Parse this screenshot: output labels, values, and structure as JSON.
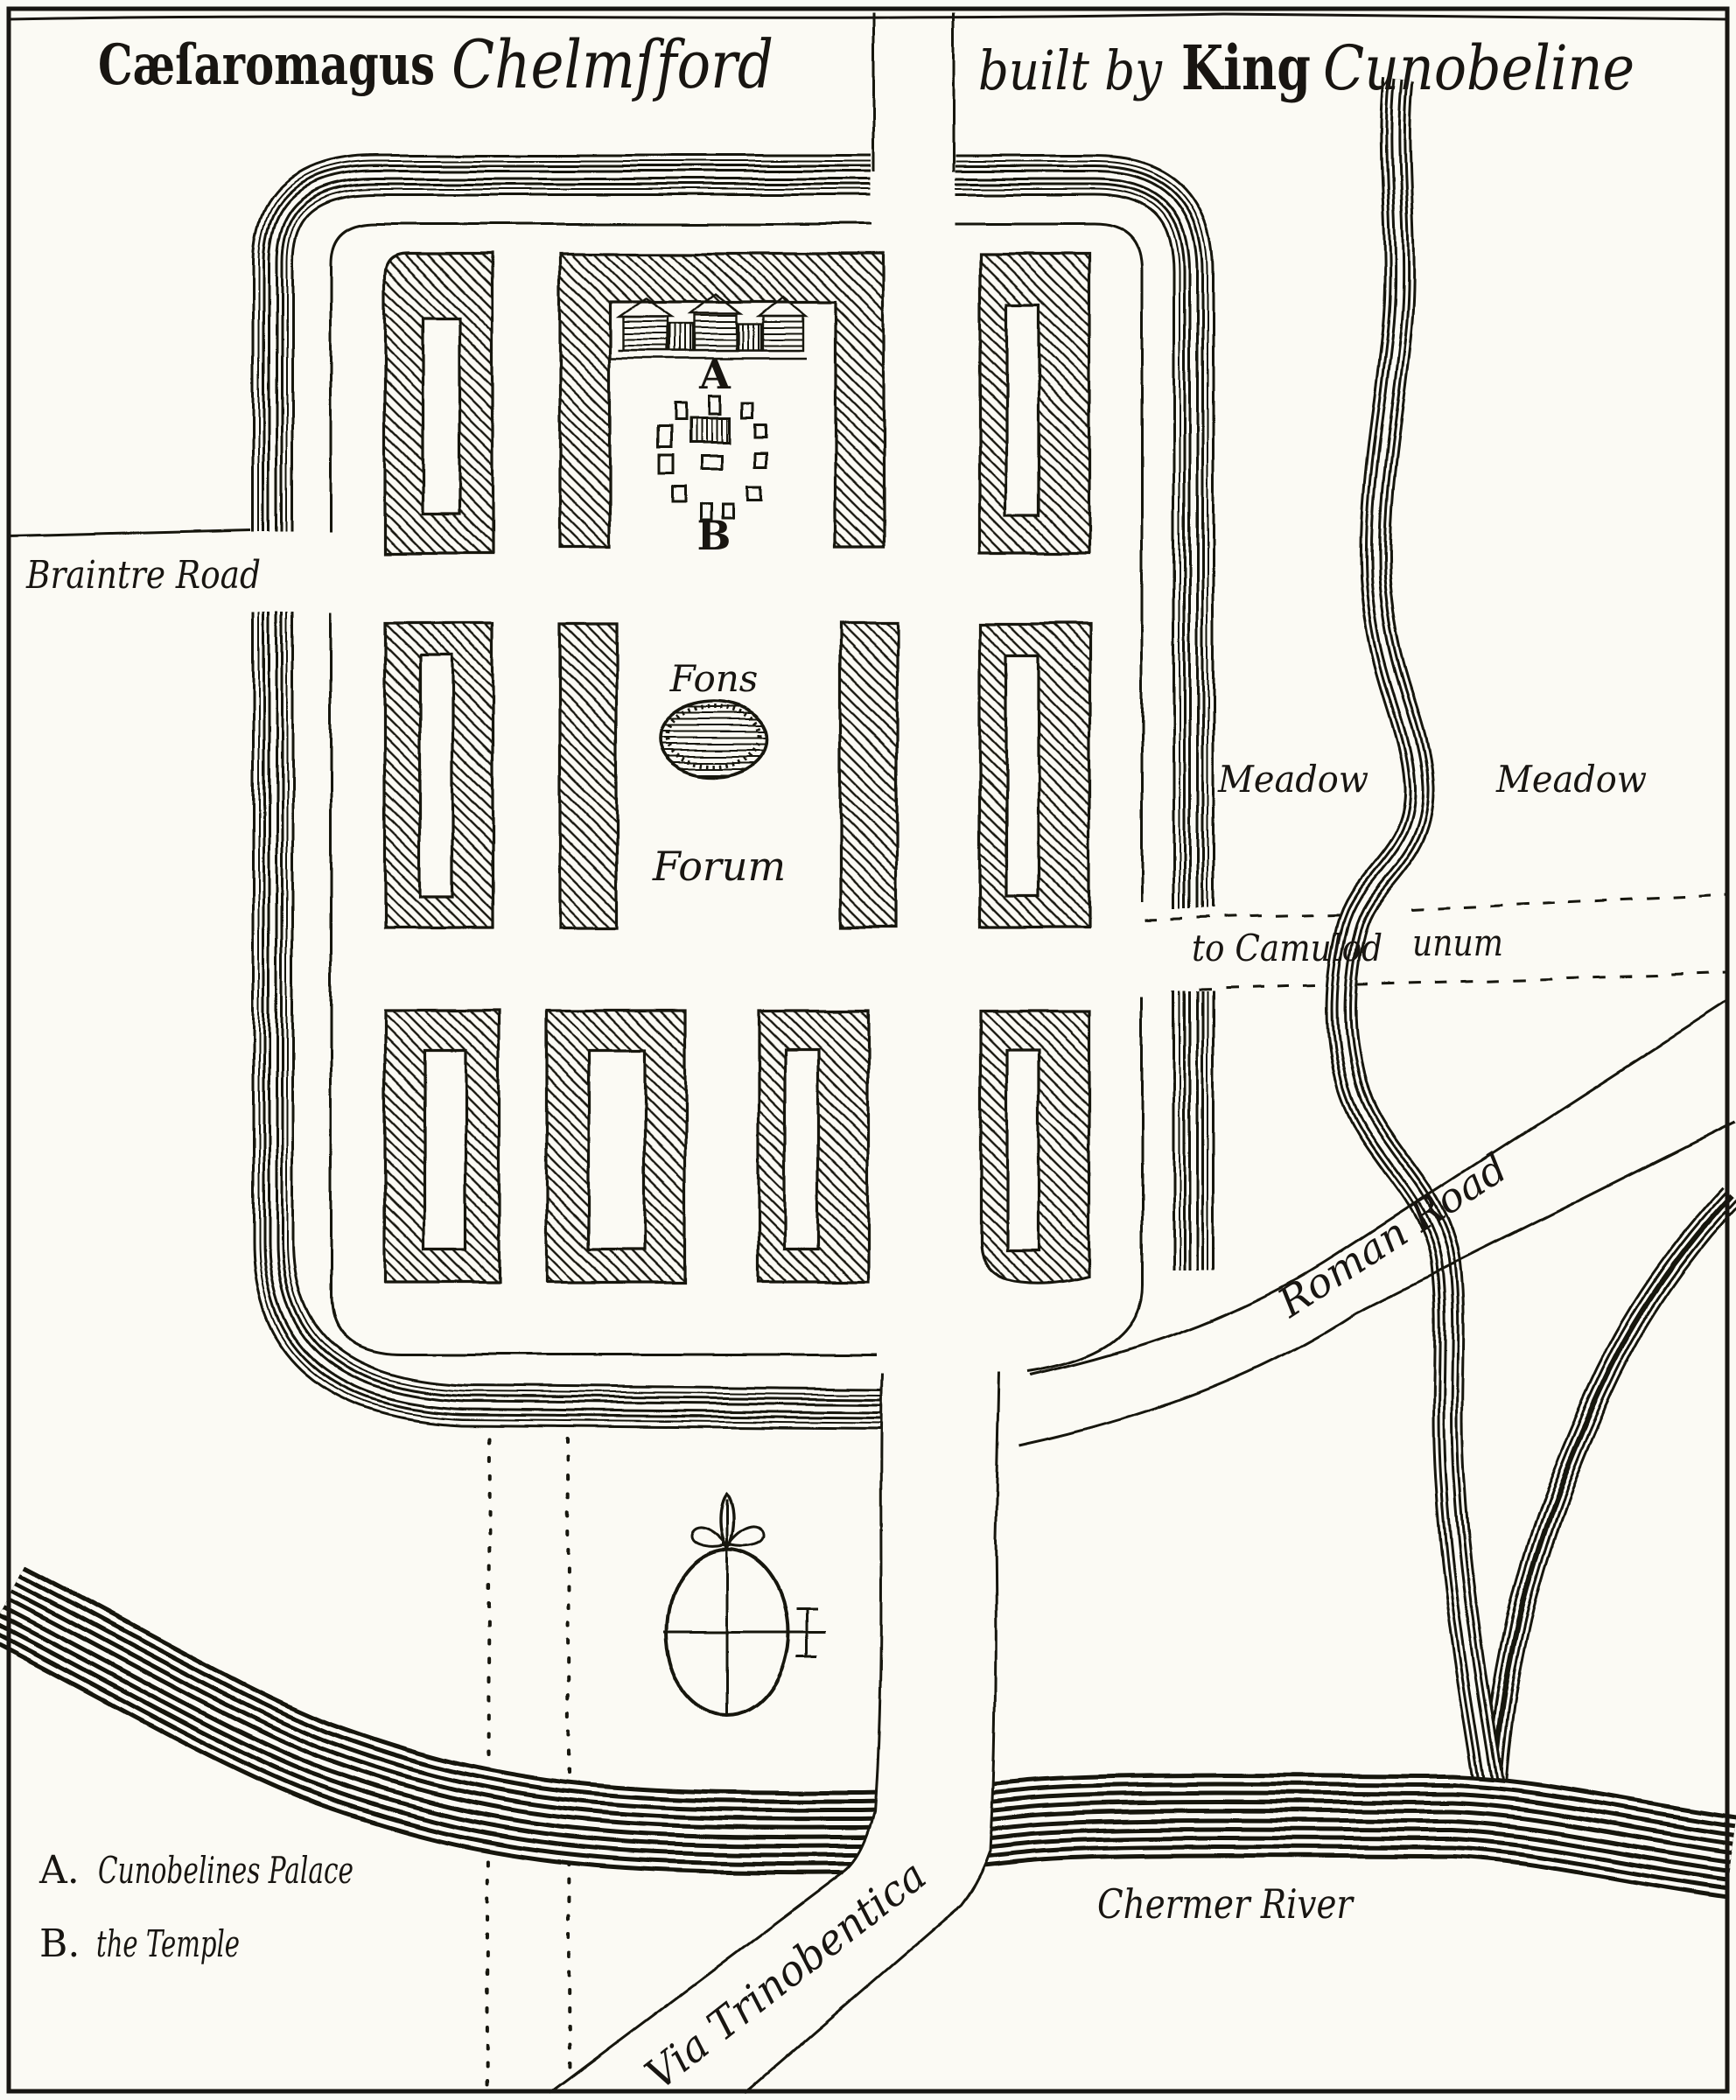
{
  "palette": {
    "paper": "#fbfaf4",
    "ink": "#181511"
  },
  "title": {
    "roman_name": "Cæſaromagus",
    "english_name": "Chelmſford",
    "built_by": "built by",
    "king": "King",
    "cunobeline": "Cunobeline"
  },
  "labels": {
    "braintre_road": "Braintre Road",
    "fons": "Fons",
    "forum": "Forum",
    "meadow_west": "Meadow",
    "meadow_east": "Meadow",
    "to_camulodunum_part1": "to Camulod",
    "to_camulodunum_part2": "unum",
    "roman_road": "Roman Road",
    "via_trinobentica": "Via Trinobentica",
    "chermer_river": "Chermer River",
    "marker_a": "A",
    "marker_b": "B"
  },
  "legend": {
    "item_a_key": "A.",
    "item_a_text": "Cunobelines Palace",
    "item_b_key": "B.",
    "item_b_text": "the Temple"
  },
  "icons": {
    "compass-rose": "circle with cross axes, fleur-de-lis north pointer, cross-potent east marker",
    "fons-pond": "oval pond with horizontal water hatching",
    "palace-elevation": "long colonnade building with three pediments",
    "temple-stones": "scatter of small rectangular stones around a striped central cella",
    "town-wall": "band of parallel wavy lines",
    "river": "band of parallel wavy lines",
    "insula-block": "diagonally hatched hollow rectangle"
  }
}
